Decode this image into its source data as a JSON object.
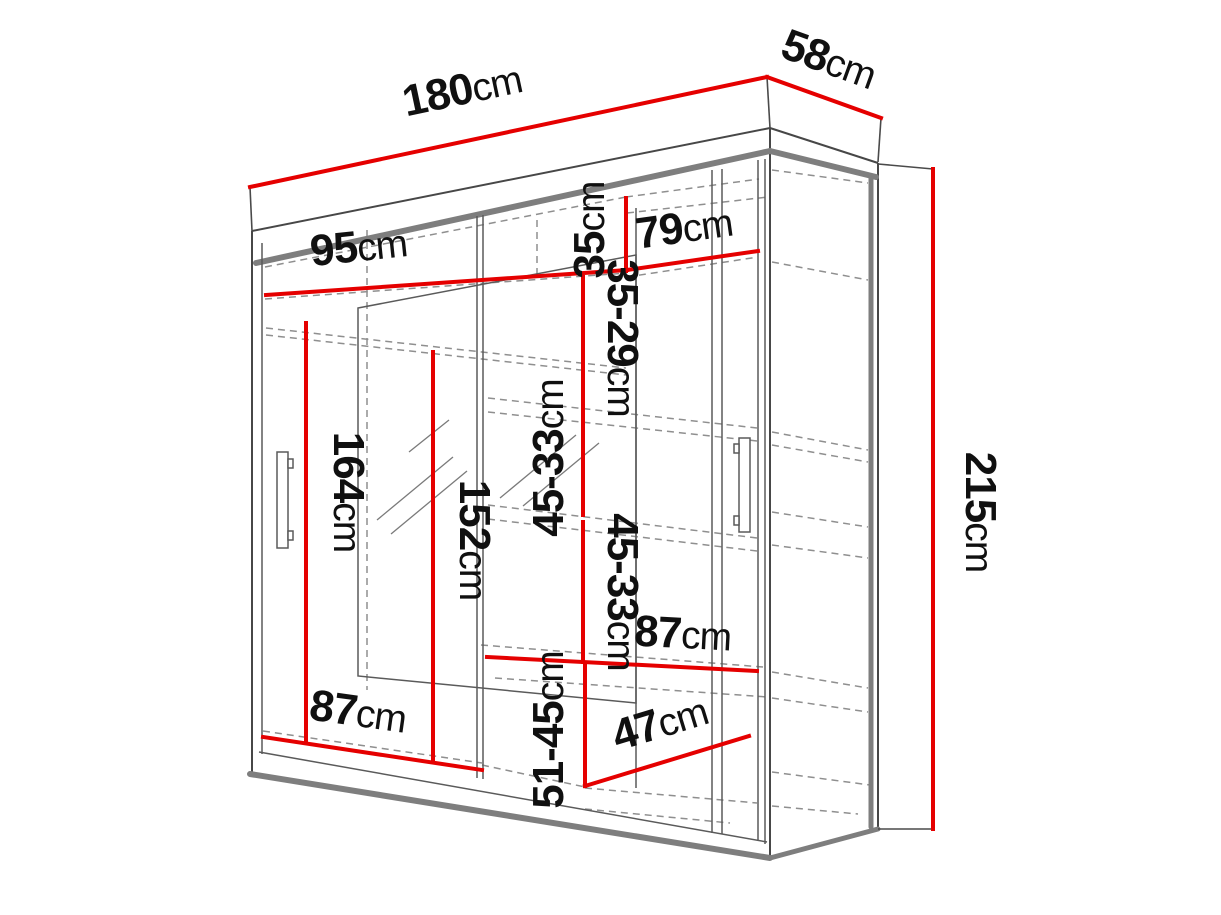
{
  "diagram": {
    "type": "furniture-dimension-drawing",
    "subject": "sliding-door mirrored wardrobe",
    "unit": "cm",
    "colors": {
      "dimension_line": "#e50000",
      "drawing_line": "#474747",
      "thick_edge": "#7e7e7e",
      "hidden_line": "#8f8f8f",
      "label_text": "#101010",
      "background": "#ffffff"
    },
    "labels": {
      "width_top": {
        "value": "180",
        "unit": "cm"
      },
      "depth_top": {
        "value": "58",
        "unit": "cm"
      },
      "height_right": {
        "value": "215",
        "unit": "cm"
      },
      "interior_left_width": {
        "value": "95",
        "unit": "cm"
      },
      "interior_right_width": {
        "value": "79",
        "unit": "cm"
      },
      "top_shelf_gap": {
        "value": "35",
        "unit": "cm"
      },
      "shelf_gap_1": {
        "value": "35-29",
        "unit": "cm"
      },
      "shelf_gap_2": {
        "value": "45-33",
        "unit": "cm"
      },
      "shelf_gap_3": {
        "value": "45-33",
        "unit": "cm"
      },
      "shelf_gap_4": {
        "value": "51-45",
        "unit": "cm"
      },
      "hanging_height": {
        "value": "164",
        "unit": "cm"
      },
      "mirror_height": {
        "value": "152",
        "unit": "cm"
      },
      "right_shelf_width": {
        "value": "87",
        "unit": "cm"
      },
      "left_bottom_width": {
        "value": "87",
        "unit": "cm"
      },
      "interior_depth": {
        "value": "47",
        "unit": "cm"
      }
    }
  }
}
